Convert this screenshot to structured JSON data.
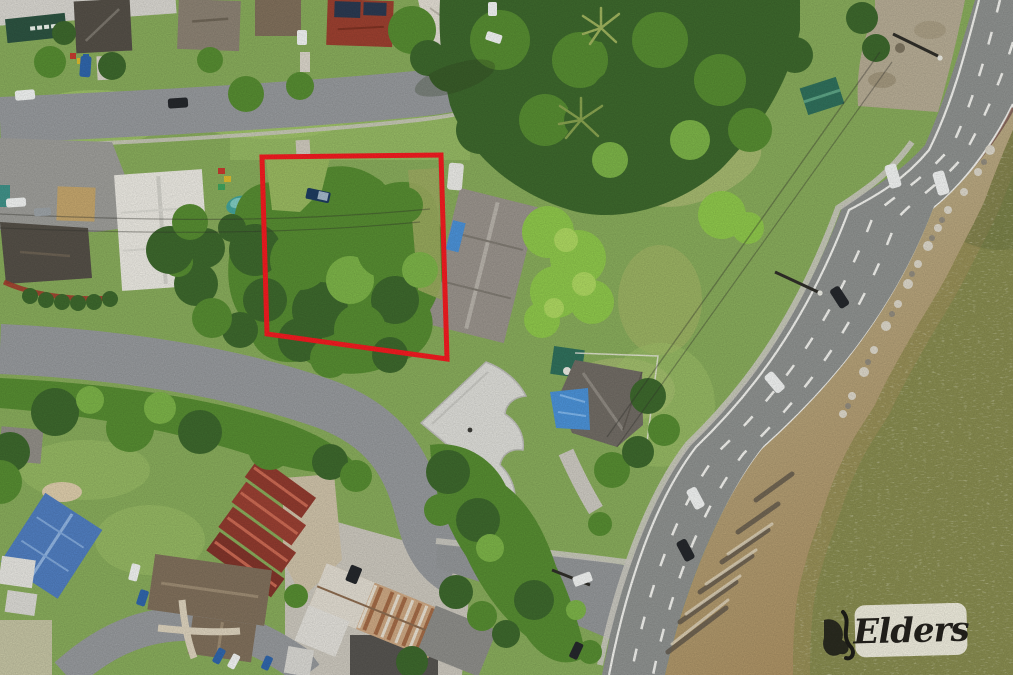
{
  "scene": {
    "type": "aerial-drone-photograph",
    "subject": "Vacant tree-covered waterfront land parcel outlined in red",
    "setting": "Residential streets top-left, four-lane foreshore road, rocky shoreline and bay water on the right"
  },
  "boundary": {
    "color": "#ee1b20",
    "stroke_width": 5,
    "points": "262,157 441,155 447,359 267,334"
  },
  "watermark": {
    "brand": "Elders",
    "bg_color": "#f1eee3",
    "text_color": "#23211c"
  },
  "palette": {
    "grassBase": "#86a95a",
    "grassLight": "#9dc068",
    "grassOlive": "#a8b468",
    "grassDry": "#b9bf7e",
    "treeDark": "#3c662c",
    "treeMid": "#558a31",
    "treeLight": "#7ab047",
    "shrubBright": "#8cc44a",
    "shrubPale": "#aad45f",
    "roadLocal": "#94979a",
    "roadHighway": "#8c8f8d",
    "laneWhite": "#eeeeea",
    "pathConcrete": "#c9c6be",
    "dirt": "#b3a992",
    "sand": "#b0976c",
    "rockLight": "#cfc8b8",
    "rockDark": "#6a5f4e",
    "water": "#85894e",
    "waterShallow": "#a3905c",
    "roofWhite": "#e7e5de",
    "roofPale": "#d6d3cb",
    "roofGray": "#97918a",
    "roofDark": "#534e46",
    "roofBrown": "#7e6e5a",
    "roofRed": "#993f2f",
    "roofBlue": "#4f7cbd",
    "tarpBlue": "#4a8fd3",
    "poolTeal": "#42a098",
    "shedTeal": "#2f6e5a",
    "rust": "#b5764c",
    "carDark": "#24272b",
    "carWhite": "#edefee",
    "carBlue": "#2f64a8",
    "wire": "#33322c",
    "solarPanel": "#2a3950"
  }
}
